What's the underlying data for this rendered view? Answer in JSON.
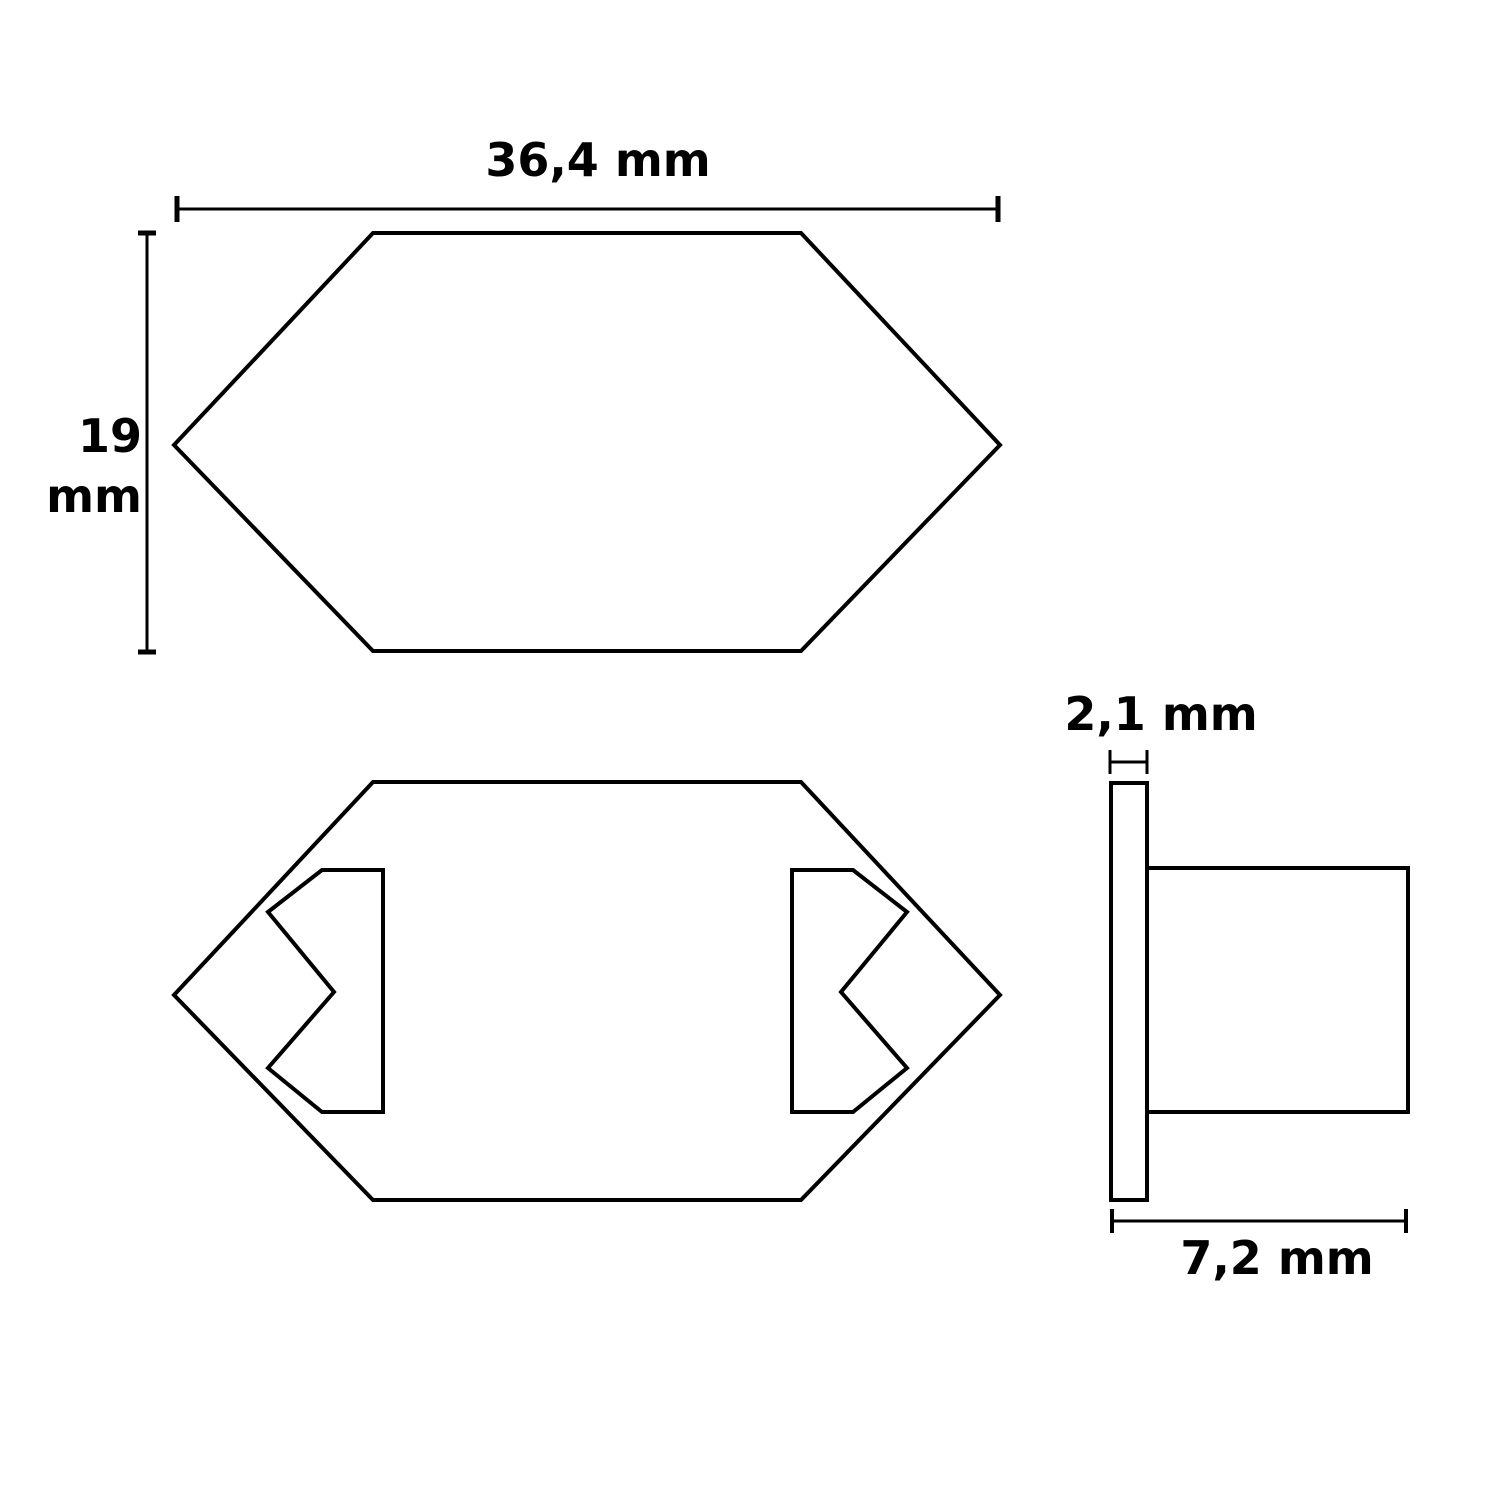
{
  "drawing": {
    "background_color": "#ffffff",
    "line_color": "#000000",
    "labels": {
      "width": "36,4 mm",
      "height_value": "19",
      "height_unit": "mm",
      "flange_thickness": "2,1 mm",
      "depth": "7,2 mm"
    }
  }
}
